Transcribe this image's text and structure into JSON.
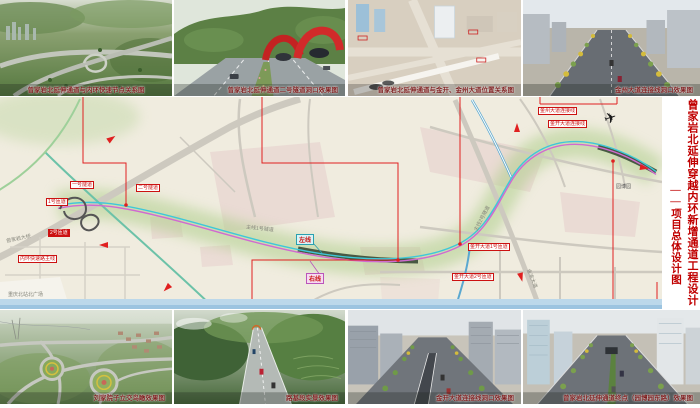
{
  "title": {
    "main": "曾家岩北延伸穿越内环新增通道工程设计",
    "sub": "——项目总体设计图"
  },
  "top_images": [
    {
      "caption": "曾家岩北延伸通道与内环快速节点关系图"
    },
    {
      "caption": "曾家岩北延伸通道二号隧道洞口效果图"
    },
    {
      "caption": "曾家岩北延伸通道与金开、金州大道位置关系图"
    },
    {
      "caption": "金州大道连接线洞口效果图"
    }
  ],
  "bottom_images": [
    {
      "caption": "刘家院子立交鸟瞰效果图"
    },
    {
      "caption": "路基段实景效果图"
    },
    {
      "caption": "金开大道连接线洞口效果图"
    },
    {
      "caption": "曾家岩北延伸通道终点（园博园东路）效果图"
    }
  ],
  "map": {
    "line_labels": {
      "left": "左线",
      "right": "右线"
    },
    "box_labels": {
      "tunnel1": "一号隧道",
      "tunnel2": "二号隧道",
      "ramp1": "1号匝道",
      "ramp2": "2号匝道",
      "inner_ring": "内环快速路主线",
      "jinzhou_link": "金州大道连接线",
      "jinkai_link": "金开大道连接线",
      "jinkai_ramp1": "金开大道1号匝道",
      "jinkai_ramp2": "金开大道2号匝道"
    },
    "place_labels": {
      "zengjiayan_bridge": "曾家岩大桥",
      "north_station": "重庆北站北广场",
      "tunnel1_main": "主线1号隧道",
      "tunnel2_main": "主线2号隧道",
      "jinyu_avenue": "金渝大道",
      "yuanboyuan": "园博园"
    },
    "airplane_icon": "✈"
  },
  "colors": {
    "accent_red": "#cc1111",
    "left_line_cyan": "#3ec8d8",
    "right_line_magenta": "#d06ad0",
    "map_background": "#f0ecdf",
    "corridor_green": "#a9cc84",
    "title_red": "#c00000"
  }
}
